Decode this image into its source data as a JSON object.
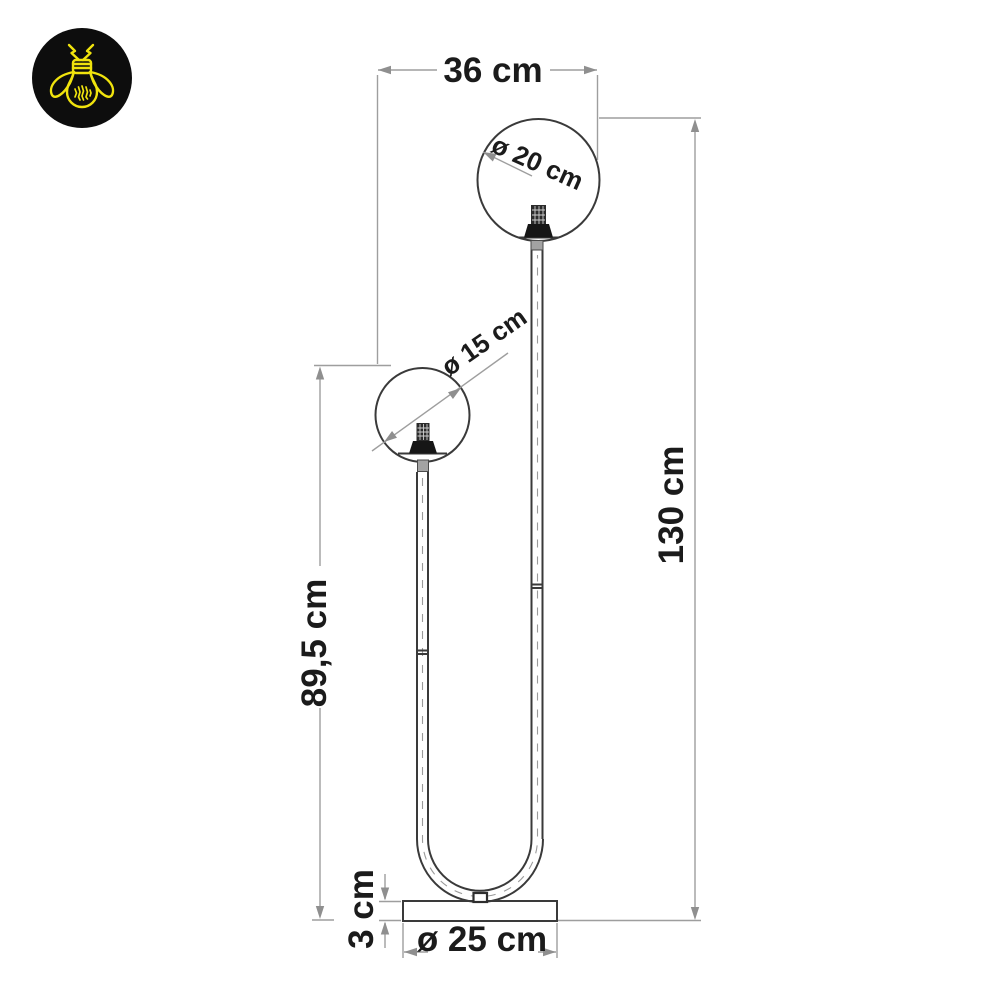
{
  "window": {
    "width": 1000,
    "height": 1000,
    "background": "#ffffff"
  },
  "logo": {
    "icon": "firefly-lightbulb-icon",
    "circle_color": "#0d0d0d",
    "icon_color": "#f0e30d"
  },
  "drawing": {
    "subject": "Two-globe floor lamp dimensional drawing",
    "outline_color": "#3a3a3a",
    "dimension_line_color": "#9e9e9e",
    "label_color": "#1b1b1b",
    "labels": {
      "top_width": "36 cm",
      "large_globe_diameter": "ø 20 cm",
      "small_globe_diameter": "ø 15 cm",
      "total_height": "130 cm",
      "left_height": "89,5 cm",
      "base_height": "3 cm",
      "base_diameter": "ø 25 cm"
    }
  }
}
